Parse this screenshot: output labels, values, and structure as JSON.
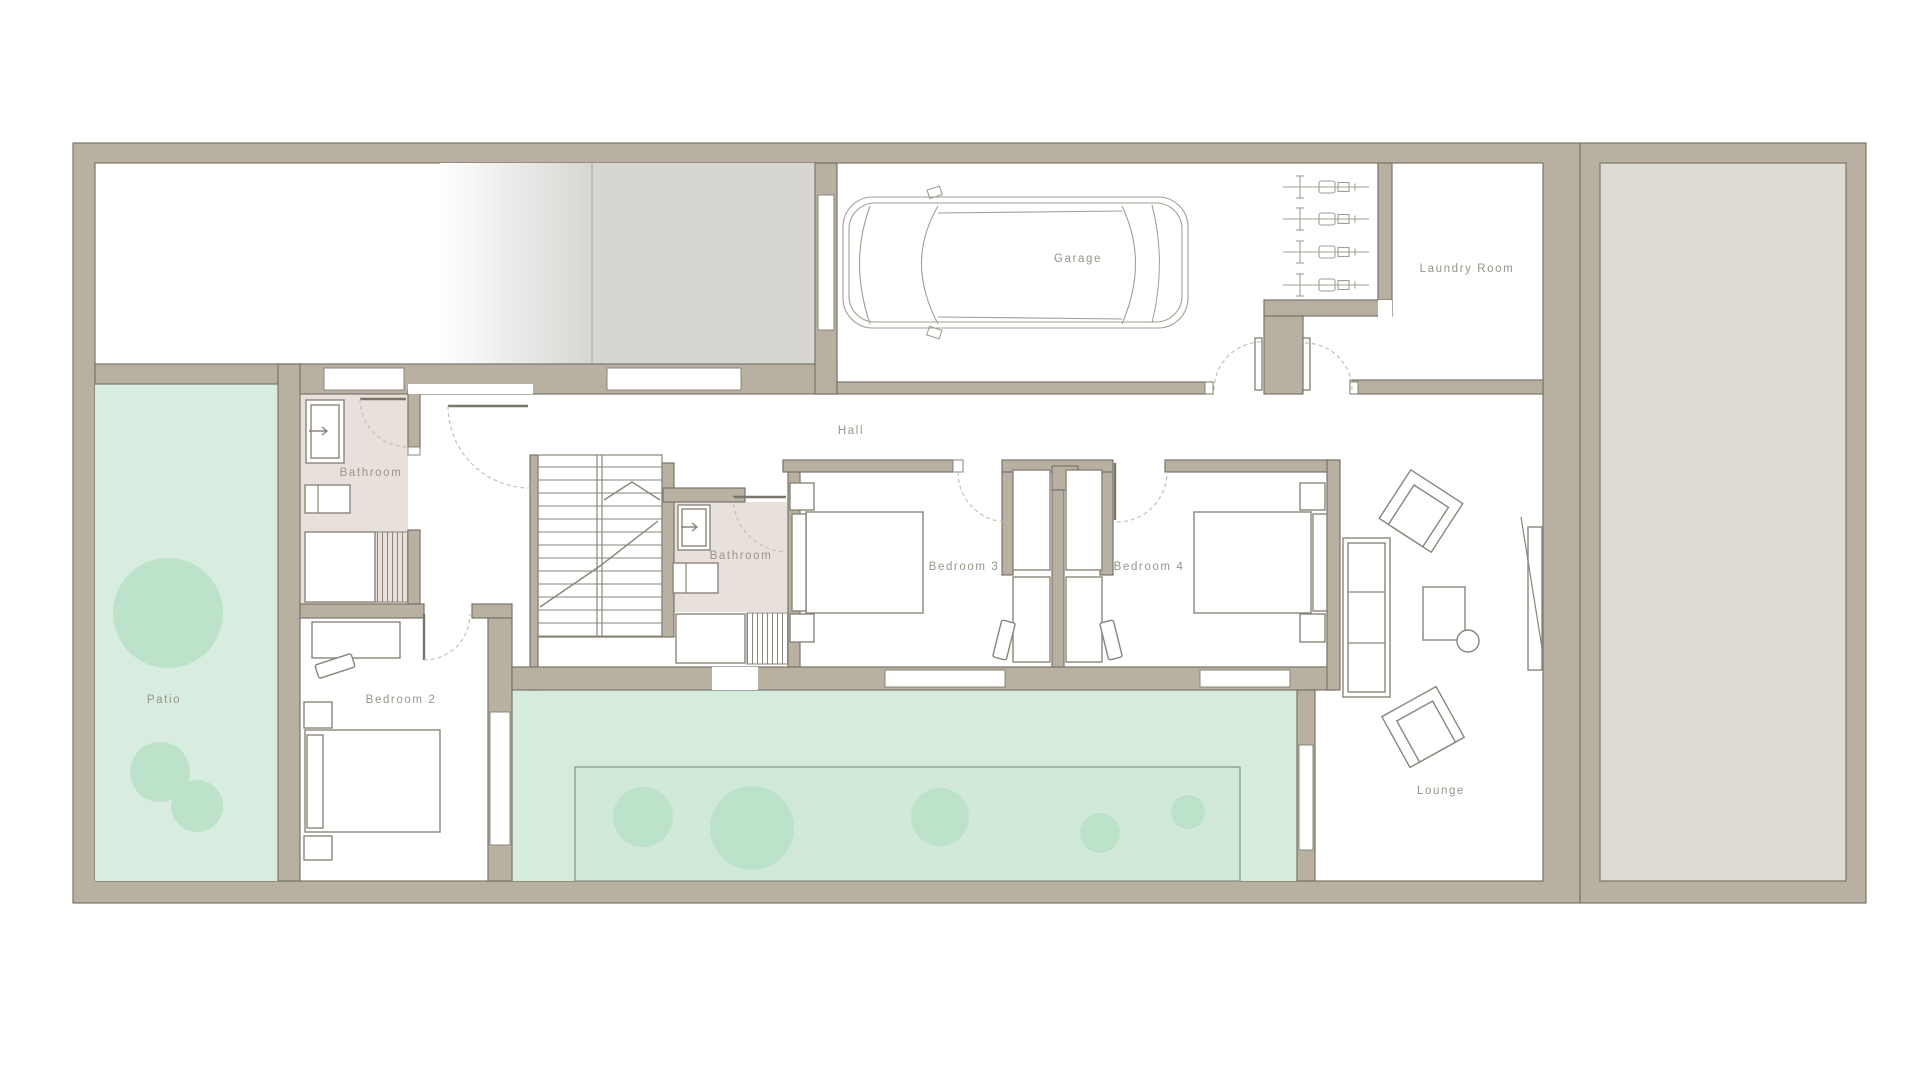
{
  "rooms": {
    "garage": "Garage",
    "laundry_room": "Laundry Room",
    "hall": "Hall",
    "bathroom_1": "Bathroom",
    "bathroom_2": "Bathroom",
    "bedroom_2": "Bedroom 2",
    "bedroom_3": "Bedroom 3",
    "bedroom_4": "Bedroom 4",
    "patio": "Patio",
    "lounge": "Lounge"
  },
  "colors": {
    "wall": "#b8b1a2",
    "wall_outline": "#7a756a",
    "line": "#8a857a",
    "bathroom_floor": "#e8e0da",
    "patio_green": "#d8ecdf",
    "courtyard_green": "#d5ebdb",
    "courtyard_inner_green": "#d0e9d8",
    "tree_green": "#bce2c9",
    "driveway_gray": "#d7d6d3",
    "adjacent_plot": "#dedbd3",
    "label_text": "#99948a"
  },
  "inventory": {
    "bikes_in_garage": 4,
    "patio_trees": 3,
    "courtyard_trees": 5,
    "lounge_armchairs": 2,
    "sofa_seats": 3
  }
}
